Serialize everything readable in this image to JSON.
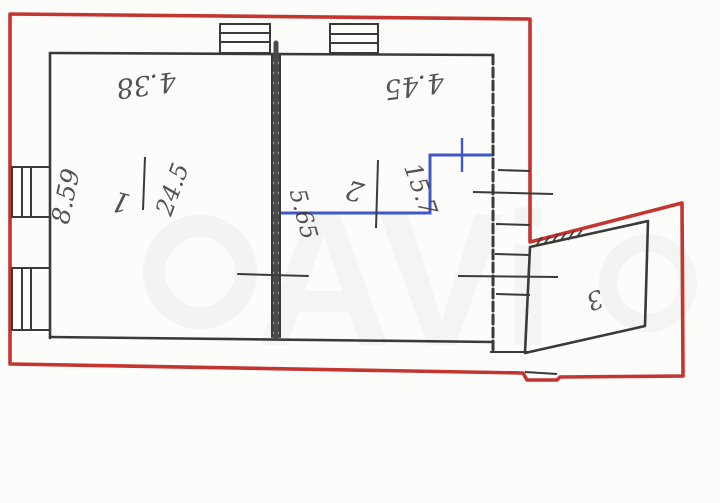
{
  "plan": {
    "description": "scanned apartment floor plan, annotations rotated upside down",
    "outline_color": "#c4352f",
    "wall_color": "#3a3a3a",
    "highlight_color": "#4157c8",
    "rooms": [
      {
        "number": "1",
        "area": "24.5"
      },
      {
        "number": "2",
        "area": "15.7"
      },
      {
        "number": "3",
        "area": ""
      }
    ],
    "dimensions": [
      {
        "label": "4.38",
        "location": "top wall of room 1"
      },
      {
        "label": "4.45",
        "location": "top wall of room 2"
      },
      {
        "label": "8.59",
        "location": "left wall"
      },
      {
        "label": "5.65",
        "location": "middle wall, at blue partition"
      }
    ],
    "watermark": {
      "letters_visible": "AVi"
    }
  }
}
